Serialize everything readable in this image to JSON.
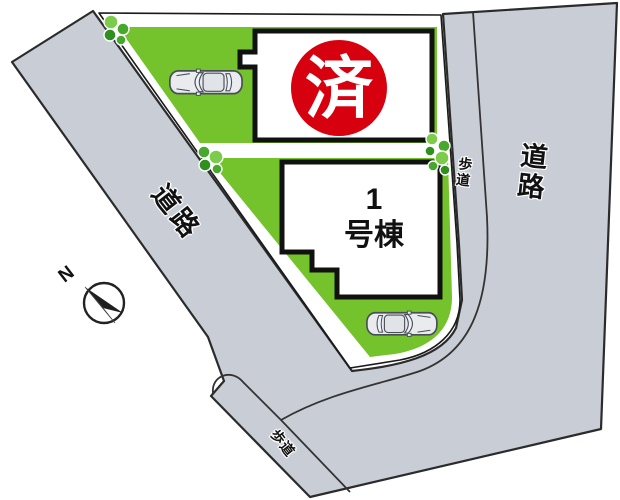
{
  "diagram": {
    "type": "residential-site-plan",
    "compass_label": "N",
    "road_left_label": "道路",
    "road_right_label": "道路",
    "sidewalk_right_label": "歩道",
    "sidewalk_bottom_label": "歩道",
    "sold_building_mark": "済",
    "building1_label": "1号棟",
    "building1_label_line1": "1",
    "building1_label_line2": "号棟",
    "lot_count": 2,
    "car_count": 2
  },
  "colors": {
    "background": "#ffffff",
    "road": "#c9ced6",
    "road_edge": "#2b2b2b",
    "grass": "#74c22c",
    "lot_border": "#1a1a1a",
    "building_fill": "#ffffff",
    "building_border": "#111111",
    "sold_red": "#d7000f",
    "tree_dark": "#2f8f1f",
    "tree_mid": "#46a82c",
    "tree_light": "#7ccb4a",
    "car_body": "#e9ebee",
    "car_glass": "#eef2f8",
    "car_line": "#4a4f57",
    "compass_dark": "#1f1f1f",
    "compass_light": "#cccccc"
  }
}
